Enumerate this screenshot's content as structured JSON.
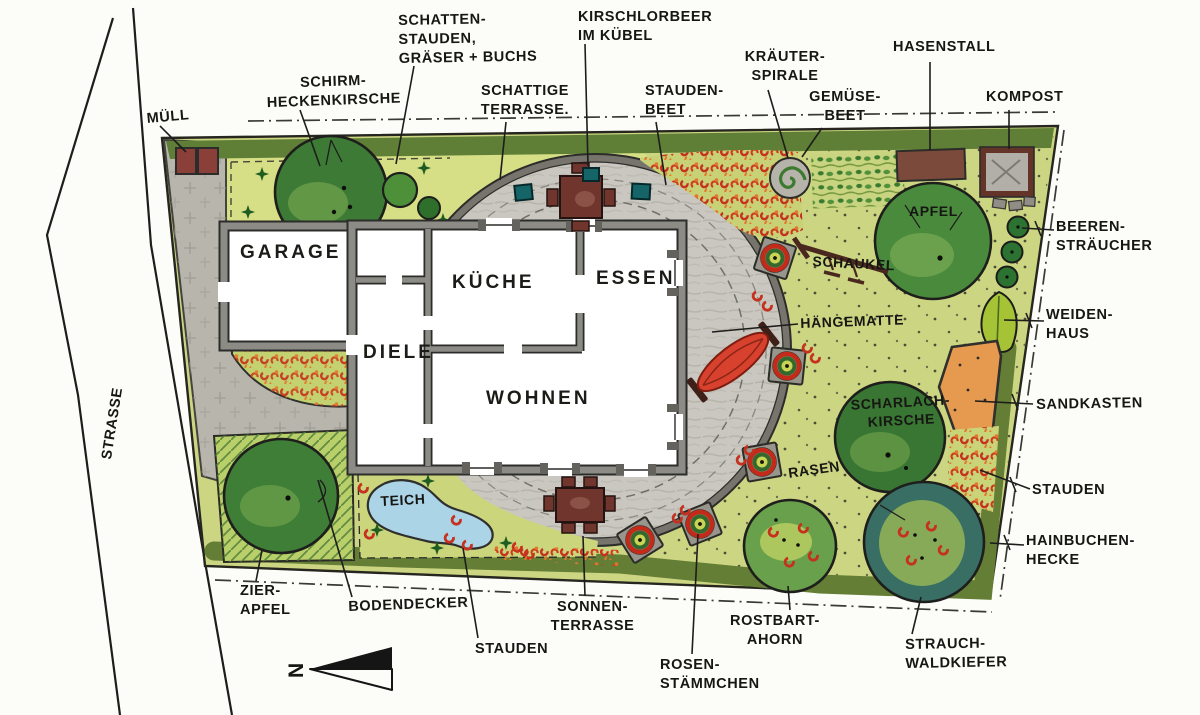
{
  "labels": {
    "strasse": "STRASSE",
    "muell": "MÜLL",
    "schirm_heckenkirsche": "SCHIRM-\nHECKENKIRSCHE",
    "schatten_stauden": "SCHATTEN-\nSTAUDEN,\nGRÄSER + BUCHS",
    "kirschlorbeer": "KIRSCHLORBEER\nIM KÜBEL",
    "schattige_terrasse": "SCHATTIGE\nTERRASSE.",
    "stauden_beet": "STAUDEN-\nBEET",
    "kraeuter_spirale": "KRÄUTER-\nSPIRALE",
    "gemuese_beet": "GEMÜSE-\nBEET",
    "hasenstall": "HASENSTALL",
    "kompost": "KOMPOST",
    "beeren_straeucher": "BEEREN-\nSTRÄUCHER",
    "weiden_haus": "WEIDEN-\nHAUS",
    "sandkasten": "SANDKASTEN",
    "stauden_rechts": "STAUDEN",
    "hainbuchen_hecke": "HAINBUCHEN-\nHECKE",
    "strauch_waldkiefer": "STRAUCH-\nWALDKIEFER",
    "rostbart_ahorn": "ROSTBART-\nAHORN",
    "rosen_staemmchen": "ROSEN-\nSTÄMMCHEN",
    "sonnen_terrasse": "SONNEN-\nTERRASSE",
    "stauden_unten": "STAUDEN",
    "bodendecker": "BODENDECKER",
    "zier_apfel": "ZIER-\nAPFEL",
    "haengematte": "HÄNGEMATTE",
    "schaukel": "SCHAUKEL",
    "apfel": "APFEL",
    "rasen": "RASEN",
    "scharlach_kirsche": "SCHARLACH-\nKIRSCHE",
    "teich": "TEICH"
  },
  "rooms": {
    "garage": "GARAGE",
    "diele": "DIELE",
    "kueche": "KÜCHE",
    "essen": "ESSEN",
    "wohnen": "WOHNEN"
  },
  "compass": {
    "letter": "N"
  },
  "palette": {
    "paper": "#fcfcf9",
    "plot_green": "#ccd682",
    "top_bed_yellow": "#d6de86",
    "hedge_olive": "#5f7e36",
    "tree_green": "#3d7a35",
    "tree_light": "#6fa24b",
    "paving_gray": "#c9c7bf",
    "driveway_gray": "#b7b5ac",
    "wall_gray": "#8c8b86",
    "pond_blue": "#abd4e6",
    "sand_orange": "#e69a50",
    "flower_red": "#c6301e",
    "wood_brown": "#70352c",
    "pot_teal": "#156467",
    "pine_bluegreen": "#386e63",
    "ink": "#1d1d1b"
  }
}
